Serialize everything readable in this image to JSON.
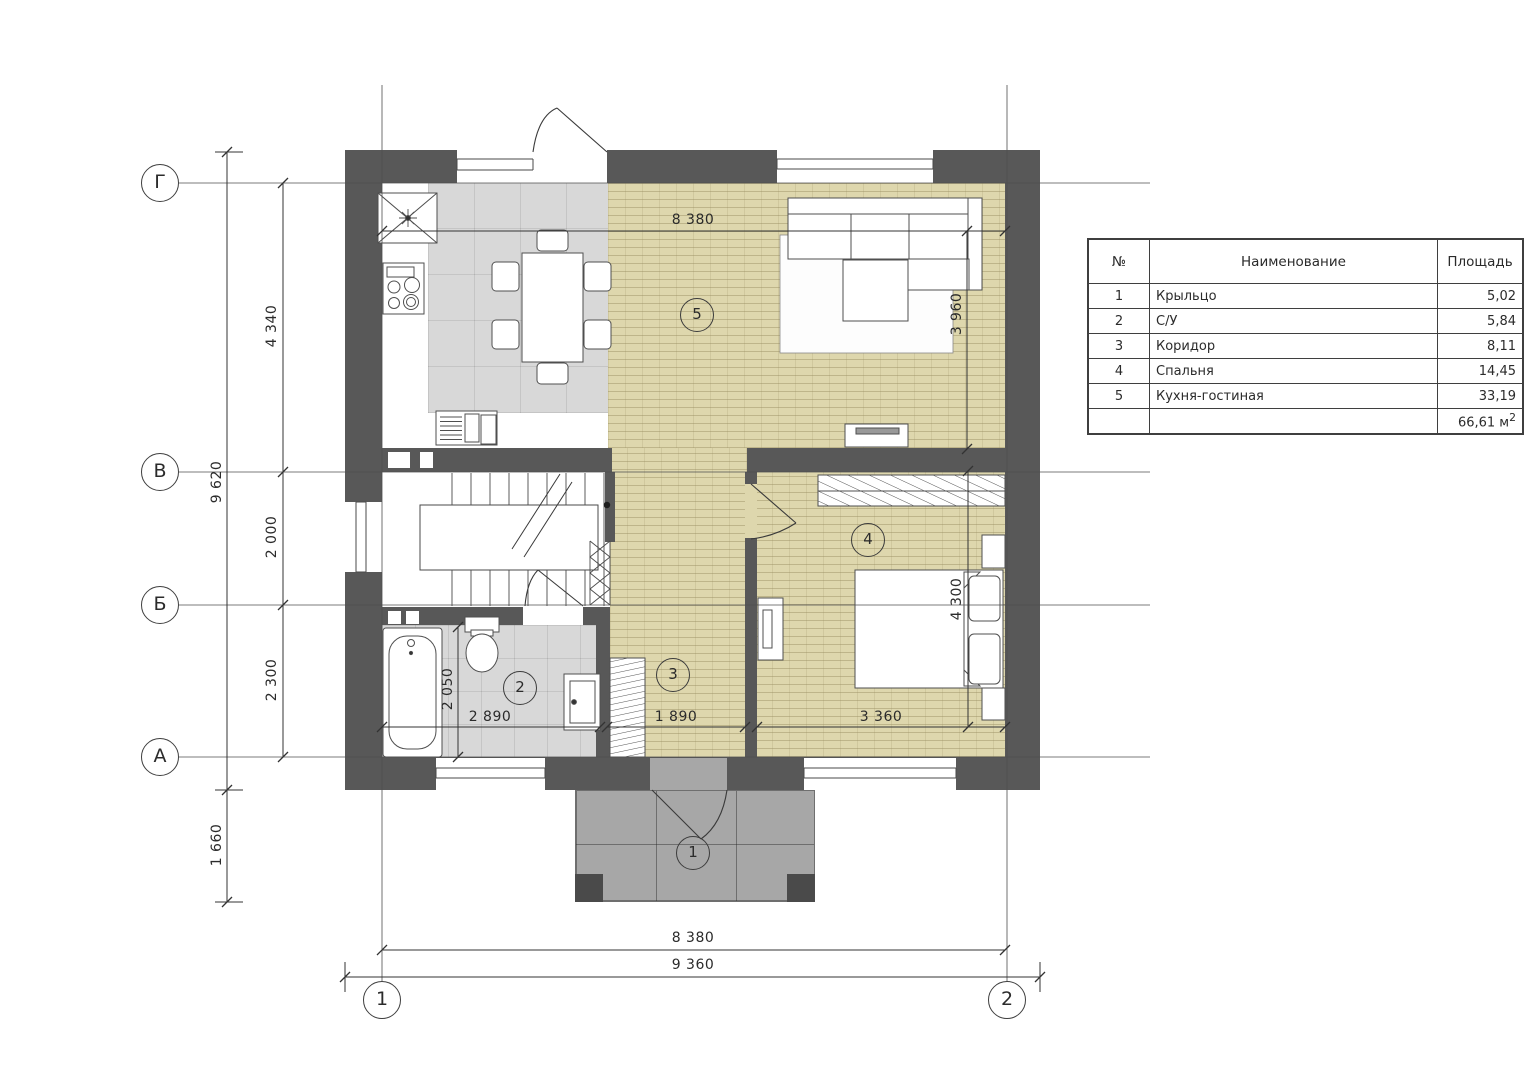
{
  "colors": {
    "wall": "#585858",
    "floor_main": "#ded7ad",
    "floor_tile": "#d8d8d8",
    "porch": "#a7a7a7"
  },
  "axes": {
    "rows": [
      "Г",
      "В",
      "Б",
      "А"
    ],
    "cols": [
      "1",
      "2"
    ]
  },
  "rooms": [
    "1",
    "2",
    "3",
    "4",
    "5"
  ],
  "dimensions": {
    "top_width": "8 380",
    "bottom_width_inner": "8 380",
    "bottom_width_outer": "9 360",
    "left_total": "9 620",
    "left_top": "4 340",
    "left_mid": "2 000",
    "left_bottom": "2 300",
    "left_porch": "1 660",
    "living_depth": "3 960",
    "bedroom_depth": "4 300",
    "bath_depth": "2 050",
    "bath_width": "2 890",
    "hall_width": "1 890",
    "bedroom_width": "3 360"
  },
  "legend": {
    "col_num": "№",
    "col_name": "Наименование",
    "col_area": "Площадь",
    "rows": [
      {
        "num": "1",
        "name": "Крыльцо",
        "area": "5,02"
      },
      {
        "num": "2",
        "name": "С/У",
        "area": "5,84"
      },
      {
        "num": "3",
        "name": "Коридор",
        "area": "8,11"
      },
      {
        "num": "4",
        "name": "Спальня",
        "area": "14,45"
      },
      {
        "num": "5",
        "name": "Кухня-гостиная",
        "area": "33,19"
      }
    ],
    "total": "66,61 м",
    "total_sup": "2"
  }
}
